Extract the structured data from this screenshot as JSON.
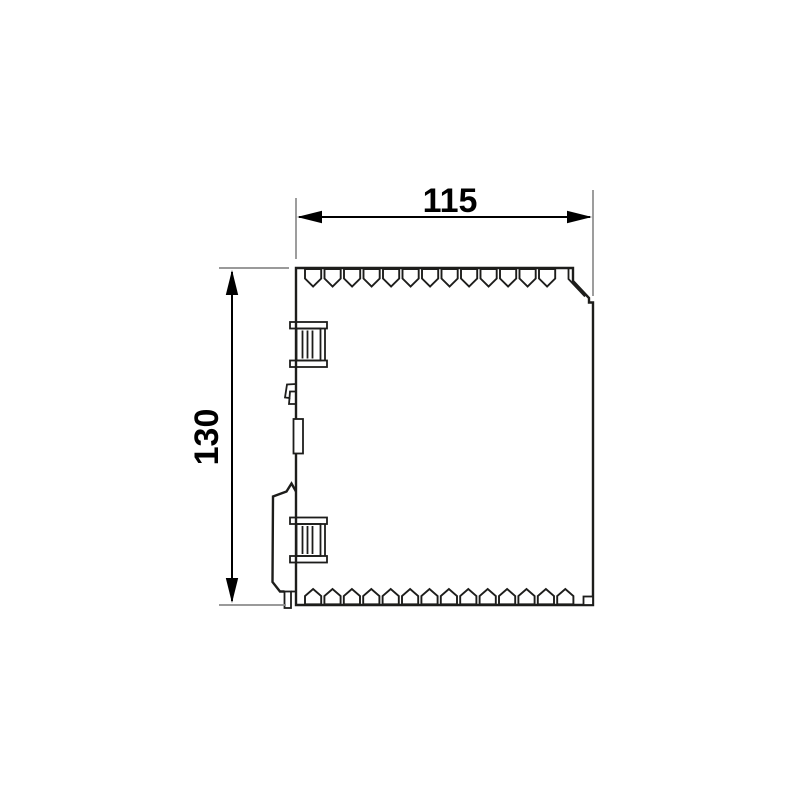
{
  "drawing": {
    "dimensions": {
      "width": {
        "label": "115"
      },
      "height": {
        "label": "130"
      }
    },
    "device": {
      "top_vent_count": 13,
      "bottom_vent_count": 14
    },
    "colors": {
      "outline": "#1d1d1b",
      "dimension": "#000000",
      "extension_line": "#8c8c8c",
      "background": "#ffffff"
    }
  }
}
